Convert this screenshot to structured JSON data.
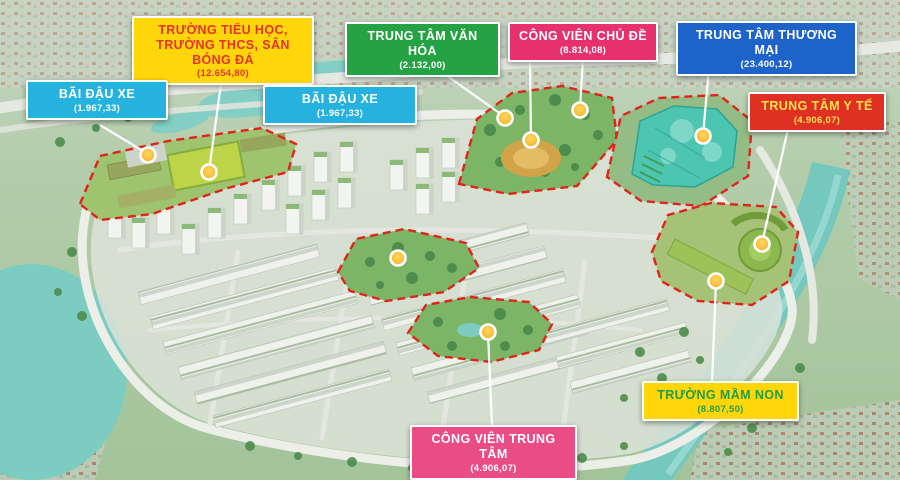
{
  "poster_title": "Master plan aerial map with land-use callouts",
  "legend_boxes": [
    {
      "key": "school",
      "title": "TRƯỜNG TIỂU HỌC, TRƯỜNG THCS, SÂN BÓNG ĐÁ",
      "area": "(12.654,80)",
      "bg": "#FFD60A",
      "fg": "#E3342B"
    },
    {
      "key": "parking_west",
      "title": "BÃI ĐẬU XE",
      "area": "(1.967,33)",
      "bg": "#25B2DE",
      "fg": "#FFFFFF"
    },
    {
      "key": "parking_central",
      "title": "BÃI ĐẬU XE",
      "area": "(1.967,33)",
      "bg": "#25B2DE",
      "fg": "#FFFFFF"
    },
    {
      "key": "culture_center",
      "title": "TRUNG TÂM VĂN HÓA",
      "area": "(2.132,00)",
      "bg": "#25A244",
      "fg": "#FFFFFF"
    },
    {
      "key": "theme_park",
      "title": "CÔNG VIÊN CHỦ ĐỀ",
      "area": "(8.814,08)",
      "bg": "#E7316F",
      "fg": "#FFFFFF"
    },
    {
      "key": "commercial_center",
      "title": "TRUNG TÂM THƯƠNG MẠI",
      "area": "(23.400,12)",
      "bg": "#1E63C9",
      "fg": "#FFFFFF"
    },
    {
      "key": "medical_center",
      "title": "TRUNG TÂM Y TẾ",
      "area": "(4.906,07)",
      "bg": "#DF3123",
      "fg": "#FFE14D"
    },
    {
      "key": "kindergarten",
      "title": "TRƯỜNG MẦM NON",
      "area": "(8.807,50)",
      "bg": "#FFD60A",
      "fg": "#1F9E45"
    },
    {
      "key": "central_park",
      "title": "CÔNG VIÊN TRUNG TÂM",
      "area": "(4.906,07)",
      "bg": "#EA4C86",
      "fg": "#FFFFFF"
    }
  ],
  "icons": {
    "marker": "yellow-location-dot",
    "zone_outline": "red-dashed-boundary"
  },
  "map_colors": {
    "zone_dash": "#E0241B",
    "marker_fill": "#F5A623",
    "connector": "#FFFFFF",
    "water": "#74C8BE",
    "commercial_building": "#4CC5B1"
  }
}
